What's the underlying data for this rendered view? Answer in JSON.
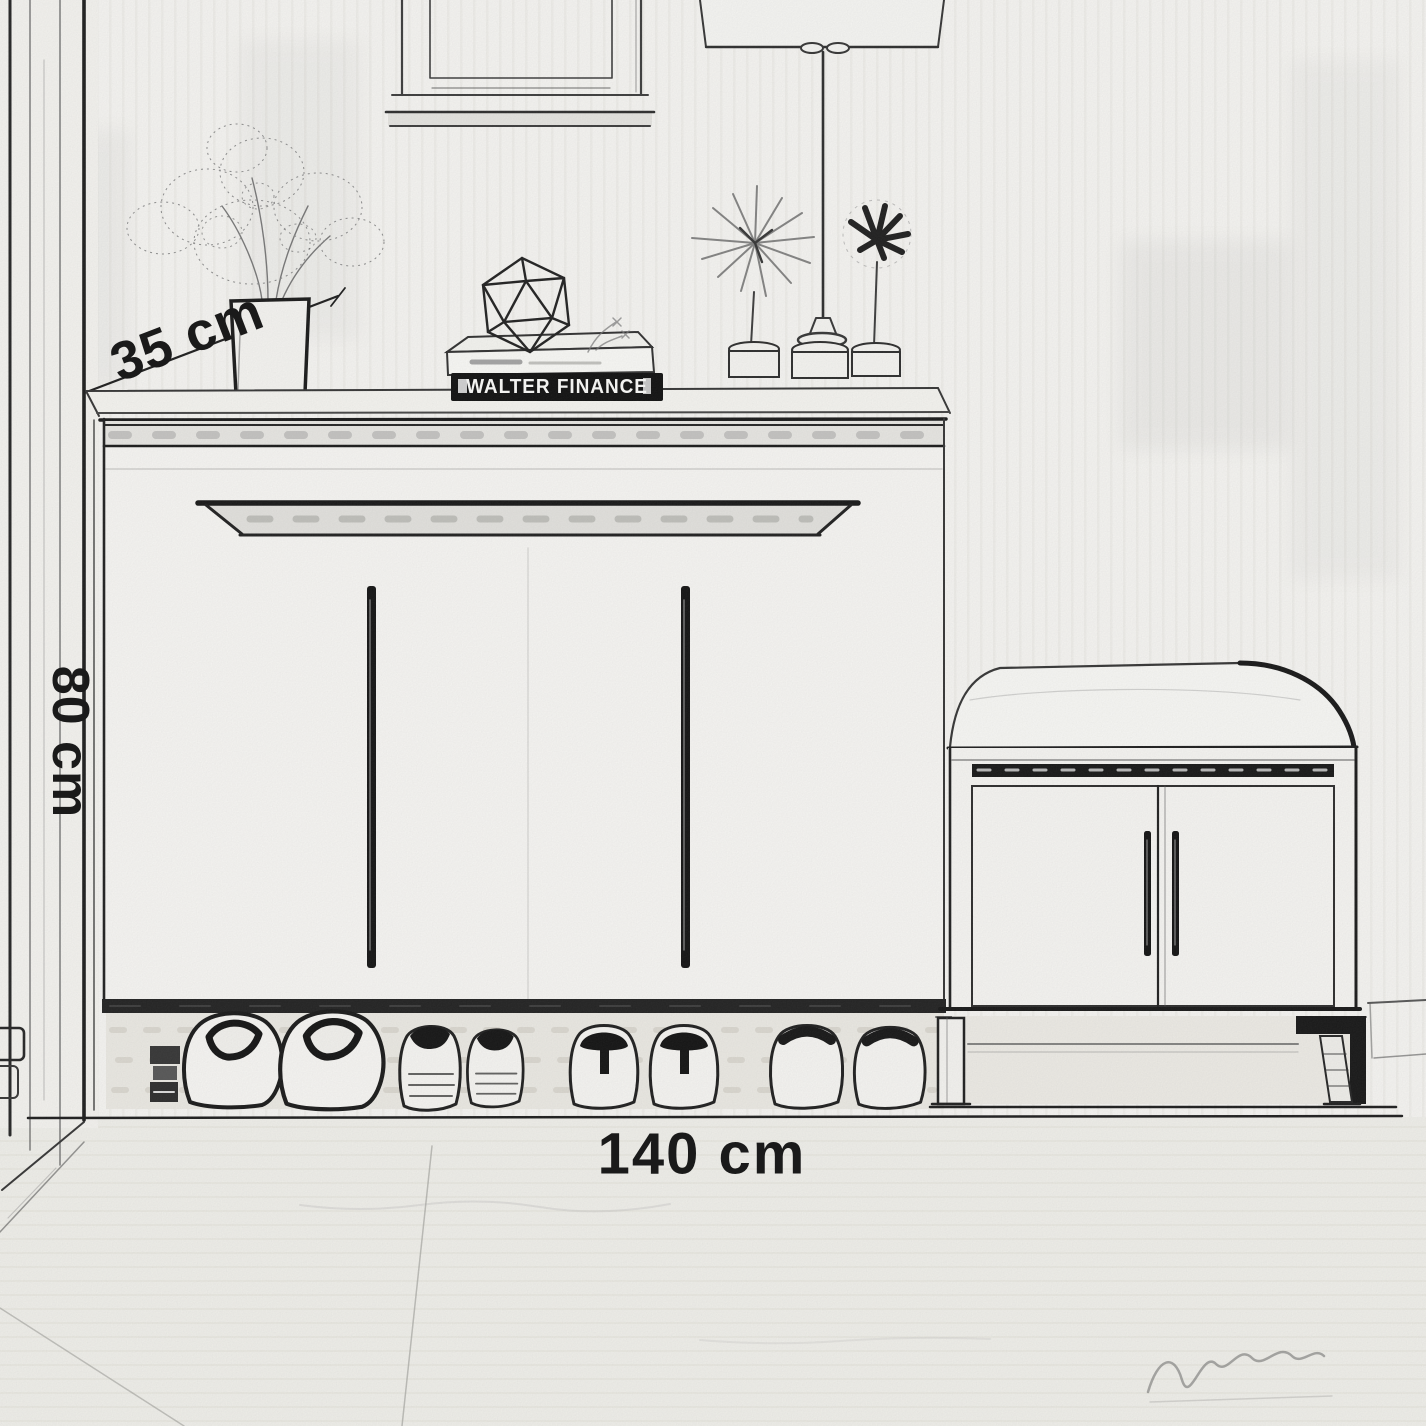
{
  "scene": {
    "description": "Pencil-sketch entryway furniture dimension drawing",
    "objects": [
      "wardrobe-door",
      "picture-frame",
      "table-lamp",
      "vase-with-plant",
      "wireframe-polyhedron-ornament",
      "stacked-books",
      "starburst-ornament",
      "flower-ornament",
      "shoe-cabinet",
      "shoes-row",
      "storage-bench-with-cushion",
      "artist-signature"
    ]
  },
  "dimensions": {
    "depth": "35 cm",
    "height": "80 cm",
    "width": "140 cm"
  },
  "book": {
    "spine_text": "WALTER FINANCE"
  },
  "colors": {
    "ink": "#1a1a1a",
    "paper": "#f8f7f4",
    "floor": "#f2f1ec",
    "spine": "#0d0d0d",
    "spine_text": "#f2f2f0",
    "soft_gray": "#8a8a8a"
  }
}
